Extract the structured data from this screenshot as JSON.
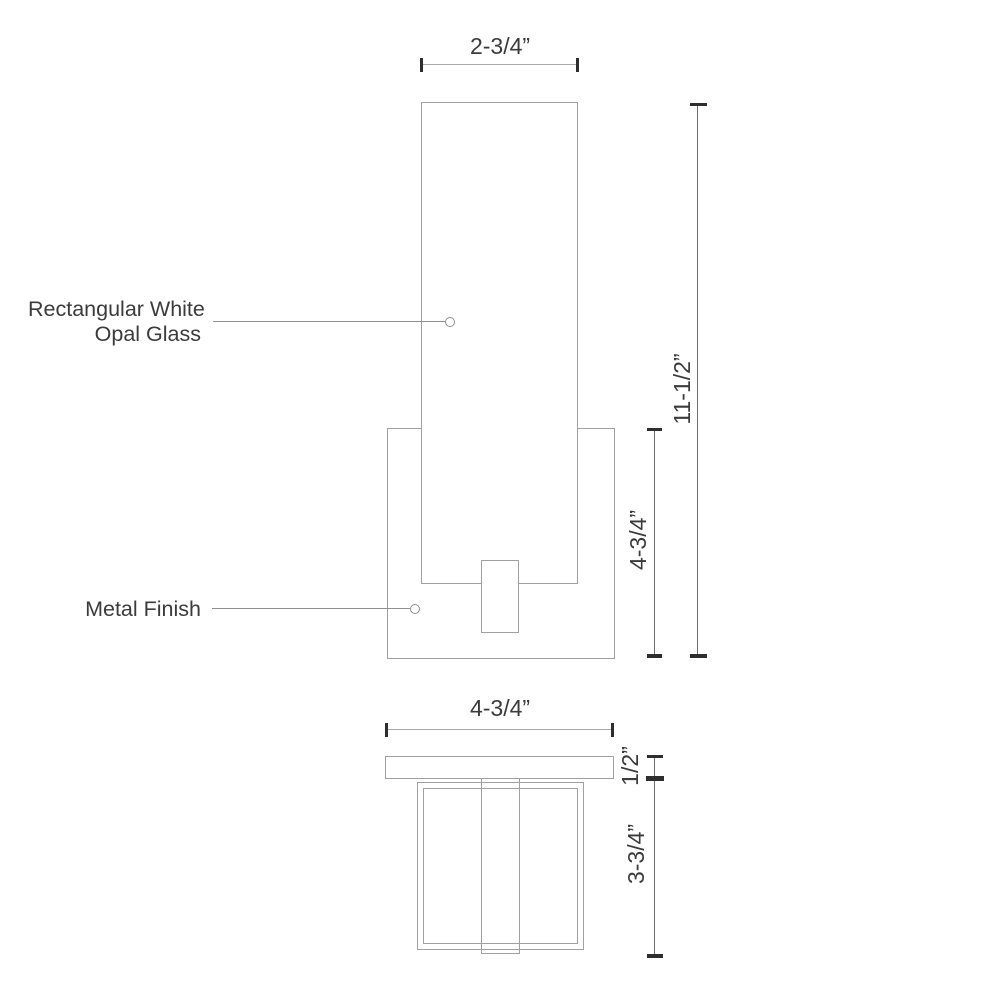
{
  "drawing": {
    "front_view": {
      "width_dim": "2-3/4”",
      "height_dim": "11-1/2”",
      "backplate_height_dim": "4-3/4”",
      "glass_label_line1": "Rectangular White",
      "glass_label_line2": "Opal Glass",
      "metal_label": "Metal Finish"
    },
    "bottom_view": {
      "width_dim": "4-3/4”",
      "plate_depth_dim": "1/2”",
      "glass_depth_dim": "3-3/4”"
    },
    "colors": {
      "shape_outline": "#a0a0a0",
      "dimension_line": "#6e6e6e",
      "leader_line": "#8f8f8f",
      "tick": "#2e2e2e",
      "text": "#3b3b3b",
      "background": "#ffffff"
    }
  }
}
